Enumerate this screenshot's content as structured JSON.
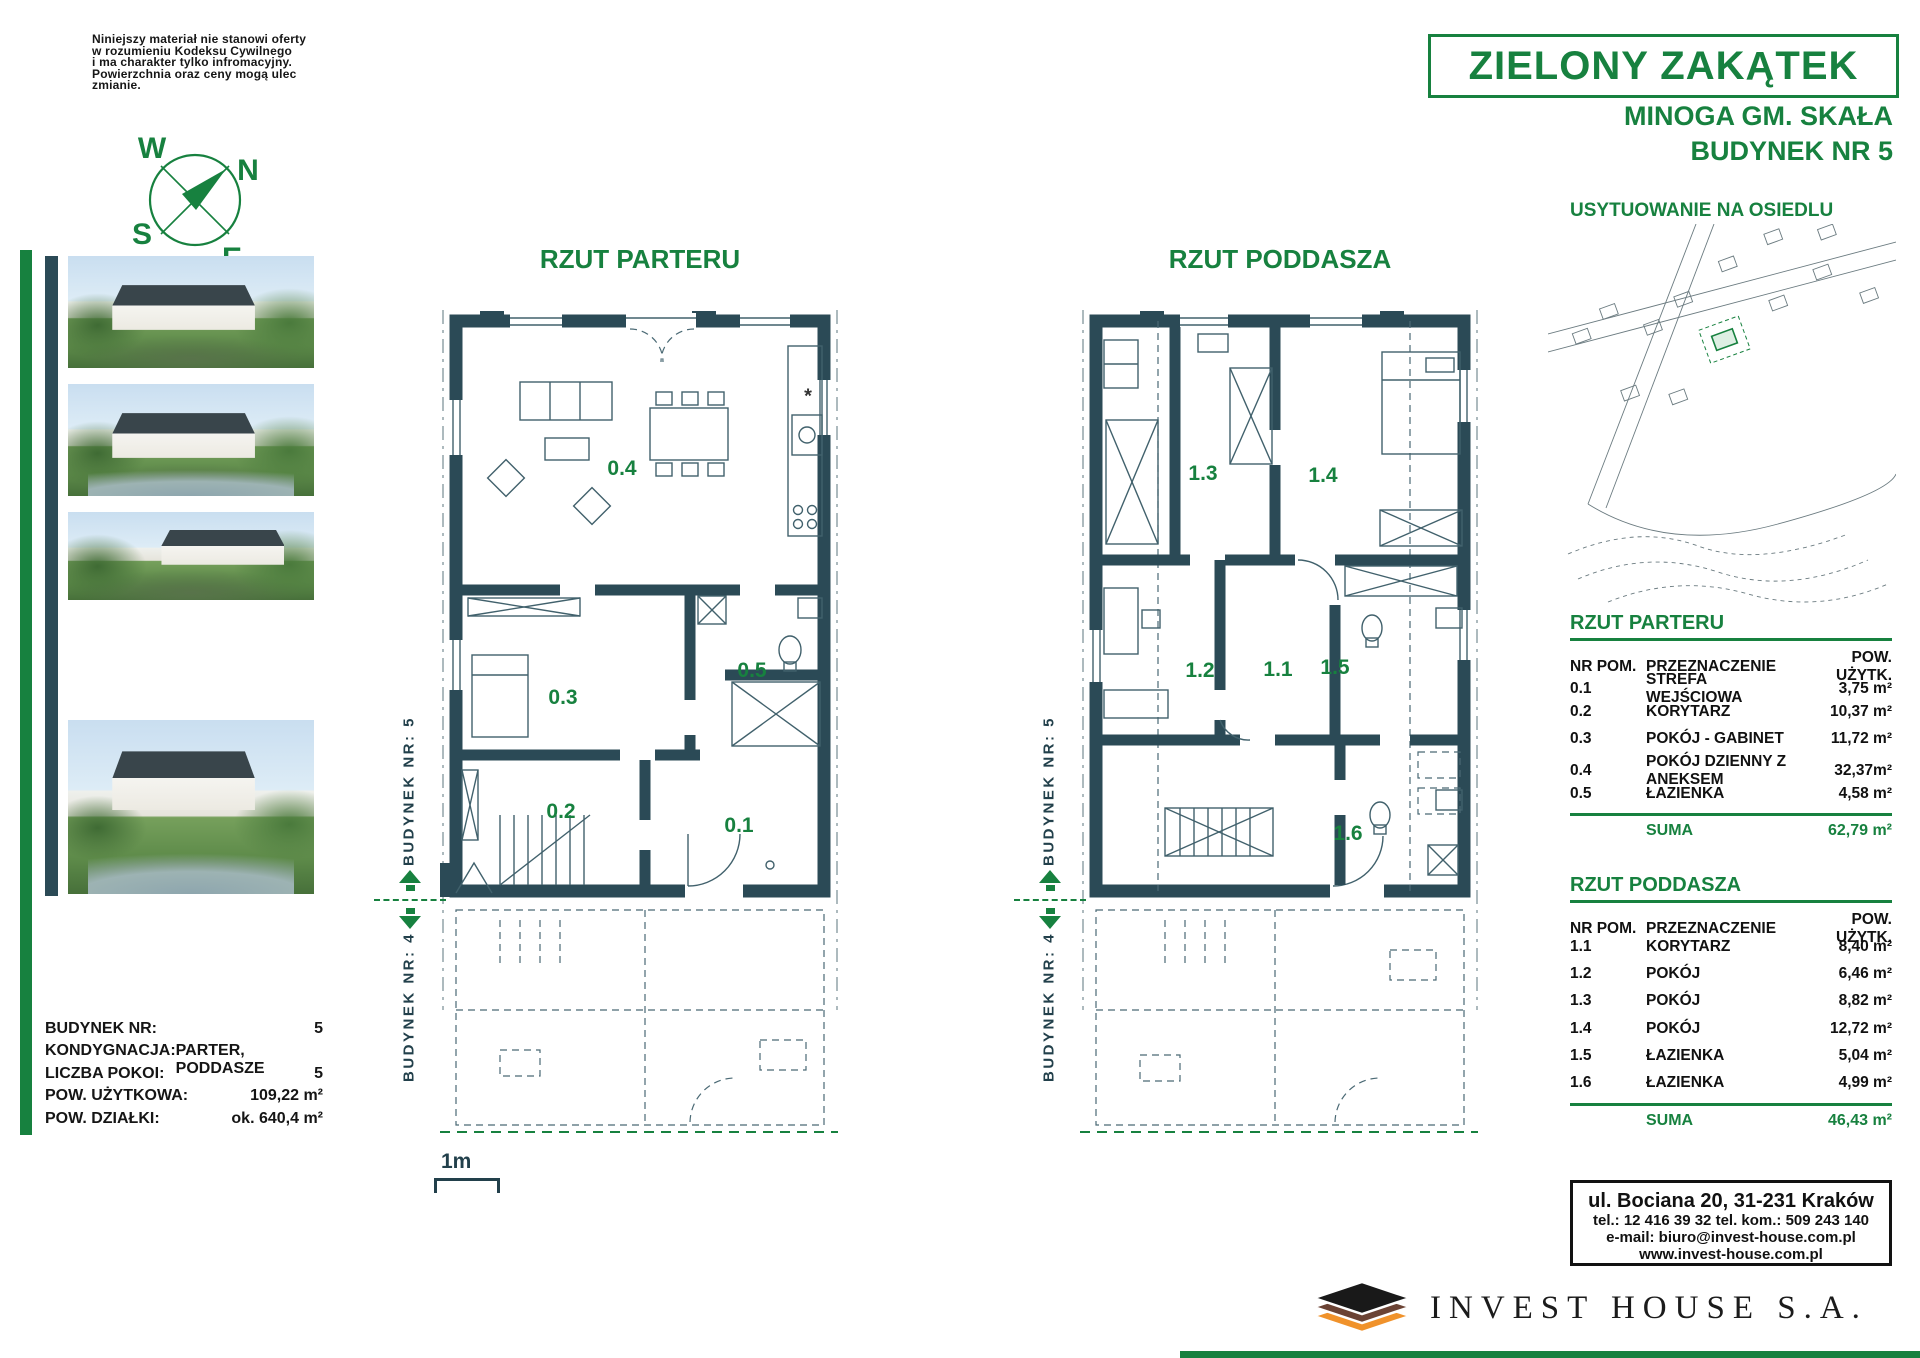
{
  "disclaimer": {
    "lines": [
      "Niniejszy materiał nie stanowi oferty",
      "w rozumieniu Kodeksu Cywilnego",
      "i ma charakter tylko infromacyjny.",
      "Powierzchnia oraz ceny mogą ulec",
      "zmianie."
    ]
  },
  "compass": {
    "n": "N",
    "s": "S",
    "e": "E",
    "w": "W"
  },
  "header": {
    "project_name": "ZIELONY ZAKĄTEK",
    "location": "MINOGA GM. SKAŁA",
    "building": "BUDYNEK NR 5"
  },
  "site_plan": {
    "title": "USYTUOWANIE NA OSIEDLU"
  },
  "floor_plans": {
    "parter": {
      "title": "RZUT PARTERU",
      "rooms": [
        "0.4",
        "0.5",
        "0.3",
        "0.2",
        "0.1"
      ],
      "kitchen_note": "*"
    },
    "poddasze": {
      "title": "RZUT PODDASZA",
      "rooms": [
        "1.3",
        "1.4",
        "1.2",
        "1.1",
        "1.5",
        "1.6"
      ]
    }
  },
  "markers": {
    "building5": "BUDYNEK NR: 5",
    "building4": "BUDYNEK NR: 4"
  },
  "scale": {
    "label": "1m"
  },
  "building_info": {
    "rows": [
      {
        "label": "BUDYNEK NR:",
        "value": "5"
      },
      {
        "label": "KONDYGNACJA:",
        "value": "PARTER, PODDASZE"
      },
      {
        "label": "LICZBA POKOI:",
        "value": "5"
      },
      {
        "label": "POW. UŻYTKOWA:",
        "value": "109,22 m²"
      },
      {
        "label": "POW. DZIAŁKI:",
        "value": "ok. 640,4 m²"
      }
    ]
  },
  "area_tables": [
    {
      "title": "RZUT PARTERU",
      "columns": {
        "nr": "NR POM.",
        "purpose": "PRZEZNACZENIE",
        "area": "POW. UŻYTK."
      },
      "rows": [
        [
          "0.1",
          "STREFA WEJŚCIOWA",
          "3,75 m²"
        ],
        [
          "0.2",
          "KORYTARZ",
          "10,37 m²"
        ],
        [
          "0.3",
          "POKÓJ - GABINET",
          "11,72 m²"
        ],
        [
          "0.4",
          "POKÓJ DZIENNY Z ANEKSEM",
          "32,37m²"
        ],
        [
          "0.5",
          "ŁAZIENKA",
          "4,58 m²"
        ]
      ],
      "suma_label": "SUMA",
      "suma": "62,79 m²"
    },
    {
      "title": "RZUT PODDASZA",
      "columns": {
        "nr": "NR POM.",
        "purpose": "PRZEZNACZENIE",
        "area": "POW. UŻYTK."
      },
      "rows": [
        [
          "1.1",
          "KORYTARZ",
          "8,40 m²"
        ],
        [
          "1.2",
          "POKÓJ",
          "6,46 m²"
        ],
        [
          "1.3",
          "POKÓJ",
          "8,82 m²"
        ],
        [
          "1.4",
          "POKÓJ",
          "12,72 m²"
        ],
        [
          "1.5",
          "ŁAZIENKA",
          "5,04 m²"
        ],
        [
          "1.6",
          "ŁAZIENKA",
          "4,99 m²"
        ]
      ],
      "suma_label": "SUMA",
      "suma": "46,43 m²"
    }
  ],
  "contact": {
    "address": "ul. Bociana 20, 31-231 Kraków",
    "phone": "tel.: 12 416 39 32  tel. kom.: 509 243 140",
    "email": "e-mail: biuro@invest-house.com.pl",
    "website": "www.invest-house.com.pl"
  },
  "logo": {
    "company": "INVEST HOUSE S.A."
  },
  "colors": {
    "green": "#17813f",
    "wall": "#2b4a56",
    "logo_orange": "#f0922b",
    "logo_brown": "#6b4334",
    "logo_black": "#191919"
  }
}
